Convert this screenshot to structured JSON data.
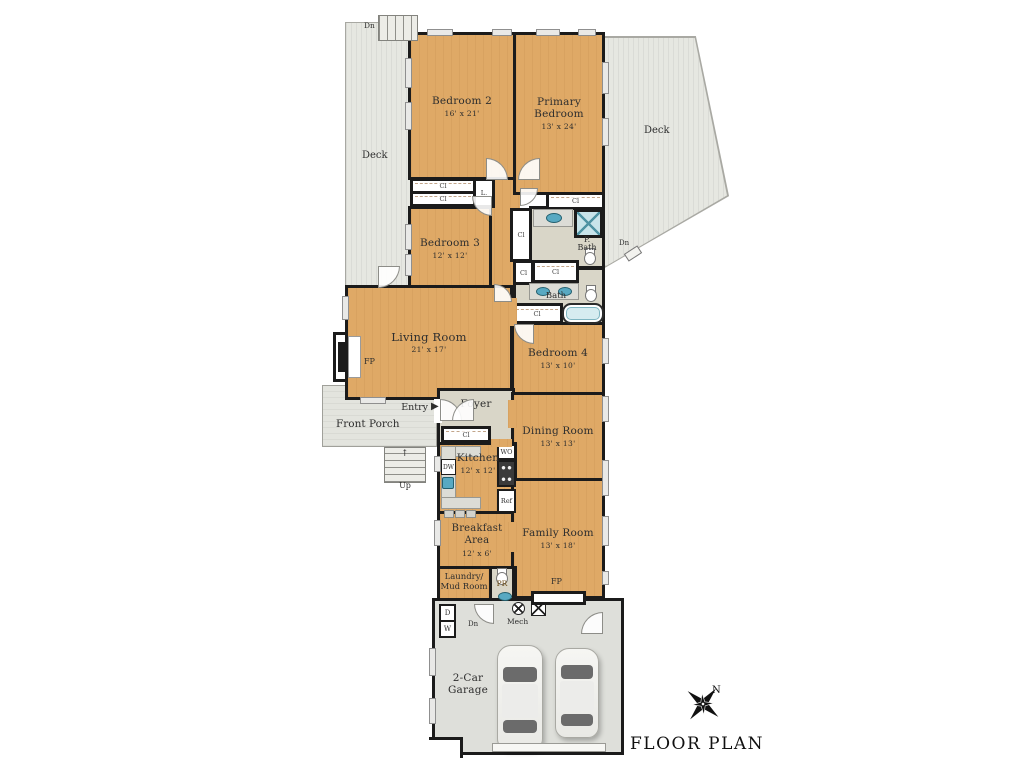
{
  "title": "FLOOR PLAN",
  "compass": {
    "north": "N"
  },
  "rooms": {
    "bedroom2": {
      "name": "Bedroom 2",
      "dims": "16' x 21'"
    },
    "primary_bedroom": {
      "name": "Primary Bedroom",
      "dims": "13' x 24'"
    },
    "bedroom3": {
      "name": "Bedroom 3",
      "dims": "12' x 12'"
    },
    "bedroom4": {
      "name": "Bedroom 4",
      "dims": "13' x 10'"
    },
    "living_room": {
      "name": "Living Room",
      "dims": "21' x 17'"
    },
    "dining_room": {
      "name": "Dining Room",
      "dims": "13' x 13'"
    },
    "kitchen": {
      "name": "Kitchen",
      "dims": "12' x 12'"
    },
    "breakfast_area": {
      "line1": "Breakfast",
      "line2": "Area",
      "dims": "12' x 6'"
    },
    "family_room": {
      "name": "Family Room",
      "dims": "13' x 18'"
    },
    "laundry": {
      "line1": "Laundry/",
      "line2": "Mud Room"
    },
    "garage": {
      "line1": "2-Car",
      "line2": "Garage"
    },
    "foyer": {
      "name": "Foyer"
    },
    "front_porch": {
      "name": "Front Porch"
    },
    "deck_left": {
      "name": "Deck"
    },
    "deck_right": {
      "name": "Deck"
    },
    "primary_bath": {
      "line1": "P.",
      "line2": "Bath"
    },
    "bath": {
      "name": "Bath"
    }
  },
  "fixtures": {
    "closet": "Cl",
    "linen": "L.",
    "fireplace": "FP",
    "dishwasher": "DW",
    "wall_oven": "WO",
    "refrigerator": "Ref",
    "powder_room": "PR",
    "dryer": "D",
    "washer": "W",
    "mechanical": "Mech"
  },
  "stairs": {
    "up": "Up",
    "down": "Dn"
  },
  "entry": {
    "label": "Entry",
    "arrow": "▶"
  },
  "colors": {
    "wood_floor": "#dfa966",
    "deck": "#e6e7e1",
    "porch": "#e3e4de",
    "garage_floor": "#dedfda",
    "tile": "#d9d6c8",
    "wall": "#1b1b1b",
    "fixture_blue": "#58a9c2"
  }
}
